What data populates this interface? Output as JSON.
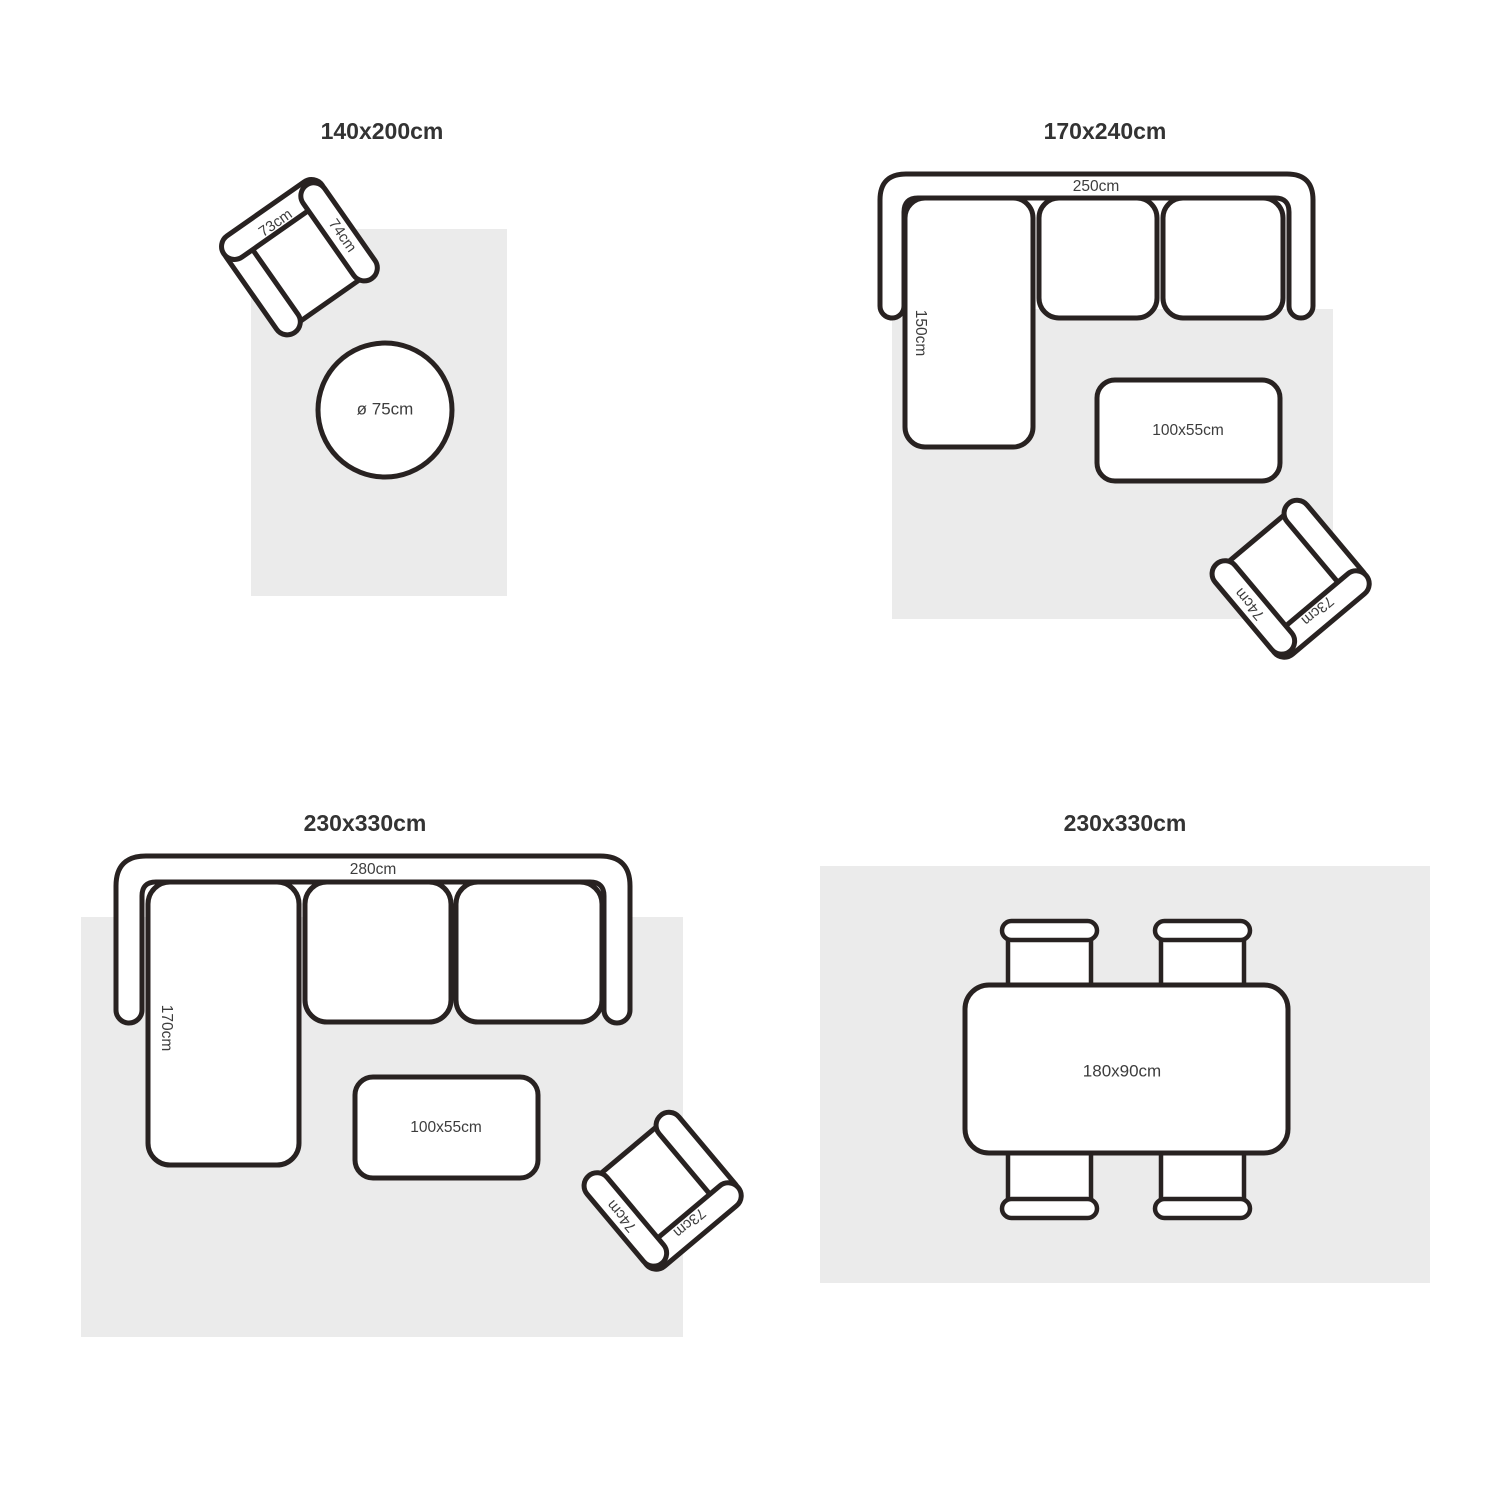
{
  "colors": {
    "background": "#ffffff",
    "outline": "#282221",
    "rug_fill": "#ebebeb",
    "title_text": "#333333",
    "label_text": "#3d3d3d"
  },
  "armchair": {
    "back_label": "73cm",
    "arm_label": "74cm"
  },
  "quadrants": {
    "top_left": {
      "title": "140x200cm",
      "round_table_label": "ø 75cm"
    },
    "top_right": {
      "title": "170x240cm",
      "sofa_width_label": "250cm",
      "sofa_depth_label": "150cm",
      "coffee_table_label": "100x55cm"
    },
    "bottom_left": {
      "title": "230x330cm",
      "sofa_width_label": "280cm",
      "sofa_depth_label": "170cm",
      "coffee_table_label": "100x55cm"
    },
    "bottom_right": {
      "title": "230x330cm",
      "dining_table_label": "180x90cm"
    }
  }
}
